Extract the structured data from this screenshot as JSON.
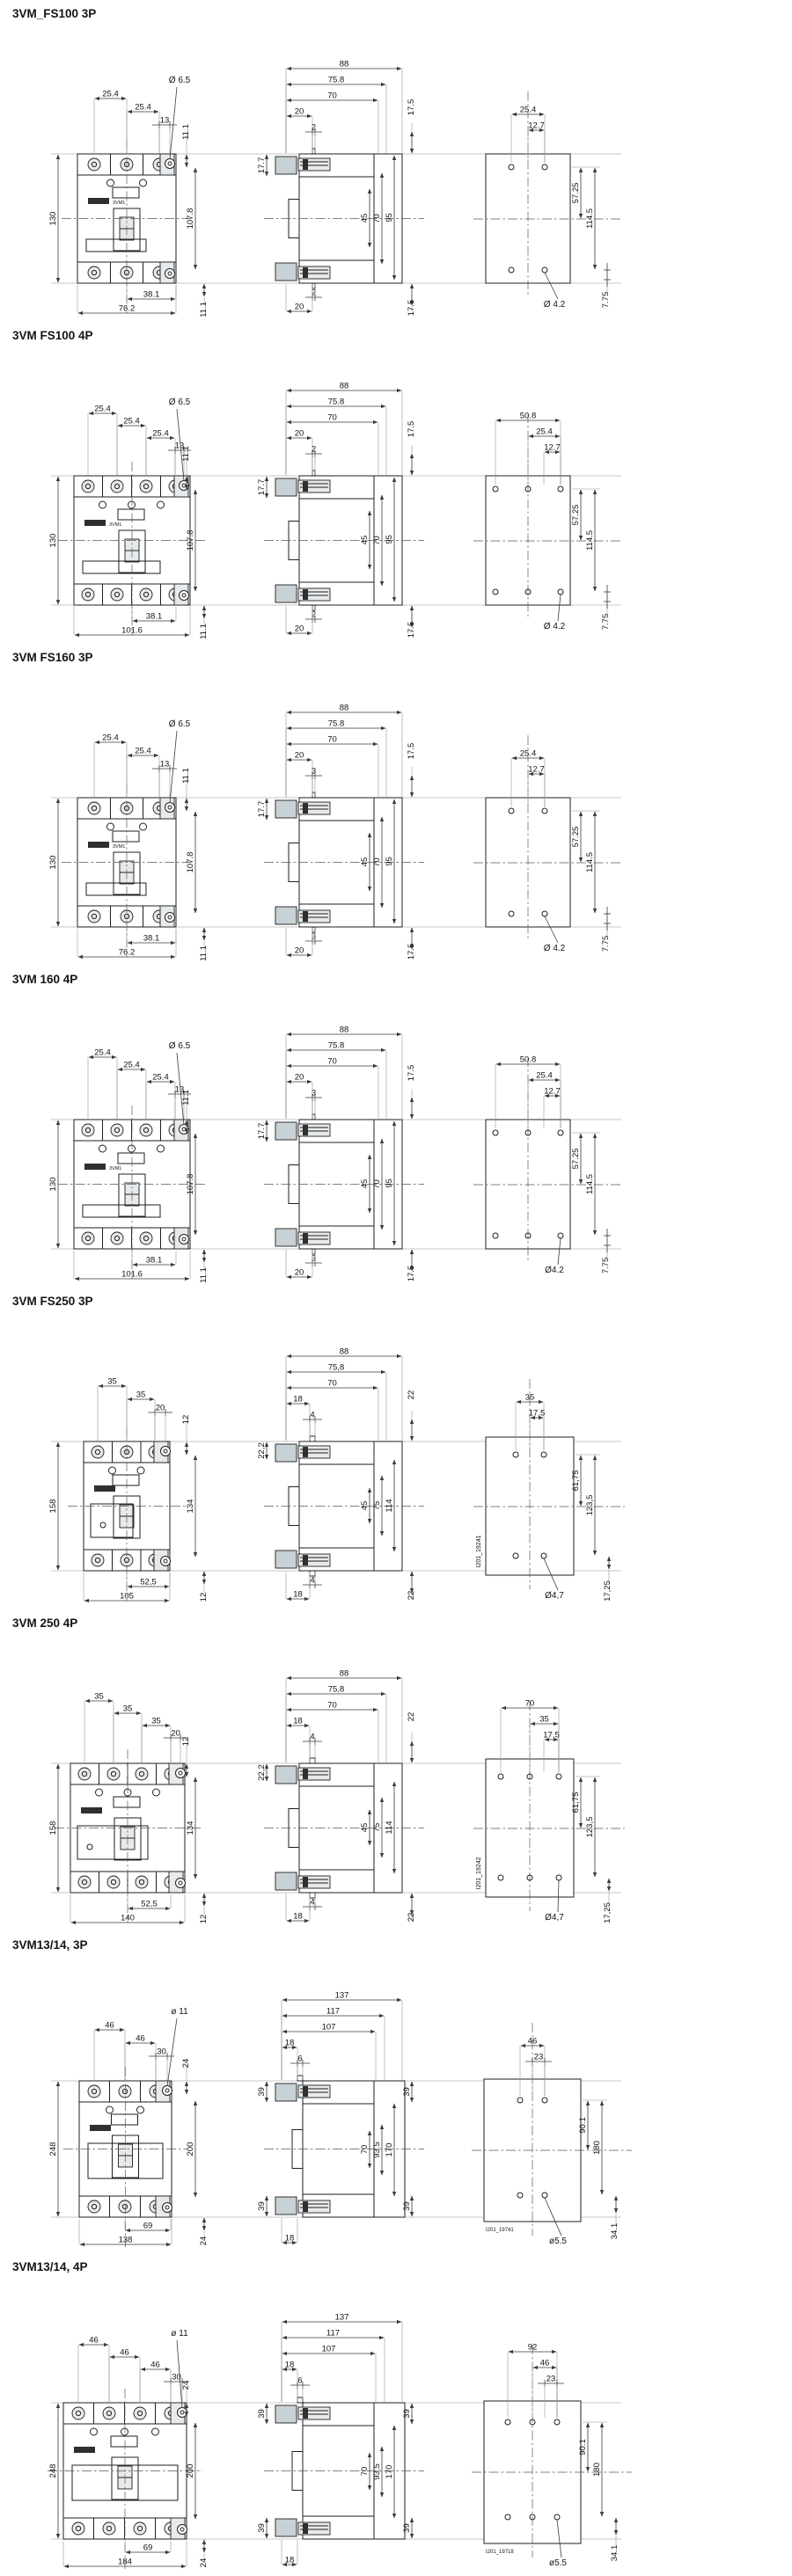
{
  "document_title": "3VM molded case circuit breaker dimension drawings",
  "palette": {
    "background": "#ffffff",
    "line": "#1f1f1f",
    "dimension_line": "#3a3a3a",
    "clamp_fill": "#c8d1d6",
    "light_fill": "#e7eaec"
  },
  "sections": [
    {
      "title": "3VM_FS100 3P",
      "family": "A",
      "poles": 3,
      "front": {
        "pitches": [
          "25.4",
          "25.4"
        ],
        "tab": "13",
        "hole": "Ø 6.5",
        "top_right": "11.1",
        "left": "130",
        "right": "107.8",
        "half": "38.1",
        "full": "76.2",
        "bottom_right": "11.1",
        "badge": "3VM1"
      },
      "side": {
        "widths": [
          "88",
          "75.8",
          "70",
          "20",
          "2"
        ],
        "top_left": "17.7",
        "top_right": "17.5",
        "inner": [
          "45",
          "70",
          "95"
        ],
        "bottom_small": "2",
        "bottom": "20",
        "bottom_right": "17.5"
      },
      "drill": {
        "top": [
          "25.4",
          "12.7"
        ],
        "right": [
          "57.25",
          "114.5"
        ],
        "hole": "Ø 4.2",
        "bottom_right": "7.75",
        "doc_id": null
      }
    },
    {
      "title": "3VM FS100 4P",
      "family": "A",
      "poles": 4,
      "front": {
        "pitches": [
          "25.4",
          "25.4",
          "25.4"
        ],
        "tab": "13",
        "hole": "Ø 6.5",
        "top_right": "11.1",
        "left": "130",
        "right": "107.8",
        "half": "38.1",
        "full": "101.6",
        "bottom_right": "11.1",
        "badge": "3VM1"
      },
      "side": {
        "widths": [
          "88",
          "75.8",
          "70",
          "20",
          "2"
        ],
        "top_left": "17.7",
        "top_right": "17.5",
        "inner": [
          "45",
          "70",
          "95"
        ],
        "bottom_small": "2",
        "bottom": "20",
        "bottom_right": "17.5"
      },
      "drill": {
        "top": [
          "50.8",
          "25.4",
          "12.7"
        ],
        "right": [
          "57.25",
          "114.5"
        ],
        "hole": "Ø 4.2",
        "bottom_right": "7.75",
        "doc_id": null
      }
    },
    {
      "title": "3VM FS160 3P",
      "family": "A",
      "poles": 3,
      "front": {
        "pitches": [
          "25.4",
          "25.4"
        ],
        "tab": "13",
        "hole": "Ø 6.5",
        "top_right": "11.1",
        "left": "130",
        "right": "107.8",
        "half": "38.1",
        "full": "76.2",
        "bottom_right": "11.1",
        "badge": "3VM1"
      },
      "side": {
        "widths": [
          "88",
          "75.8",
          "70",
          "20",
          "3"
        ],
        "top_left": "17.7",
        "top_right": "17.5",
        "inner": [
          "45",
          "70",
          "95"
        ],
        "bottom_small": "3",
        "bottom": "20",
        "bottom_right": "17.5"
      },
      "drill": {
        "top": [
          "25.4",
          "12.7"
        ],
        "right": [
          "57.25",
          "114.5"
        ],
        "hole": "Ø 4.2",
        "bottom_right": "7.75",
        "doc_id": null
      }
    },
    {
      "title": "3VM 160 4P",
      "family": "A",
      "poles": 4,
      "front": {
        "pitches": [
          "25.4",
          "25.4",
          "25.4"
        ],
        "tab": "13",
        "hole": "Ø 6.5",
        "top_right": "11.1",
        "left": "130",
        "right": "107.8",
        "half": "38.1",
        "full": "101.6",
        "bottom_right": "11.1",
        "badge": "3VM1"
      },
      "side": {
        "widths": [
          "88",
          "75.8",
          "70",
          "20",
          "3"
        ],
        "top_left": "17.7",
        "top_right": "17.5",
        "inner": [
          "45",
          "70",
          "95"
        ],
        "bottom_small": "3",
        "bottom": "20",
        "bottom_right": "17.5"
      },
      "drill": {
        "top": [
          "50.8",
          "25.4",
          "12.7"
        ],
        "right": [
          "57.25",
          "114.5"
        ],
        "hole": "Ø4.2",
        "bottom_right": "7.75",
        "doc_id": null
      }
    },
    {
      "title": "3VM FS250 3P",
      "family": "B",
      "poles": 3,
      "front": {
        "pitches": [
          "35",
          "35"
        ],
        "tab": "20",
        "hole": null,
        "top_right": "12",
        "left": "158",
        "right": "134",
        "half": "52,5",
        "full": "105",
        "bottom_right": "12",
        "badge": null
      },
      "side": {
        "widths": [
          "88",
          "75,8",
          "70",
          "18",
          "4"
        ],
        "top_left": "22,2",
        "top_right": "22",
        "inner": [
          "45",
          "75",
          "114"
        ],
        "bottom_small": "4",
        "bottom": "18",
        "bottom_right": "22"
      },
      "drill": {
        "top": [
          "35",
          "17,5"
        ],
        "right": [
          "61,75",
          "123,5"
        ],
        "hole": "Ø4,7",
        "bottom_right": "17,25",
        "doc_id": "I201_19241"
      }
    },
    {
      "title": "3VM 250 4P",
      "family": "B",
      "poles": 4,
      "front": {
        "pitches": [
          "35",
          "35",
          "35"
        ],
        "tab": "20",
        "hole": null,
        "top_right": "12",
        "left": "158",
        "right": "134",
        "half": "52,5",
        "full": "140",
        "bottom_right": "12",
        "badge": null
      },
      "side": {
        "widths": [
          "88",
          "75,8",
          "70",
          "18",
          "4"
        ],
        "top_left": "22,2",
        "top_right": "22",
        "inner": [
          "45",
          "75",
          "114"
        ],
        "bottom_small": "4",
        "bottom": "18",
        "bottom_right": "22"
      },
      "drill": {
        "top": [
          "70",
          "35",
          "17,5"
        ],
        "right": [
          "61,75",
          "123,5"
        ],
        "hole": "Ø4,7",
        "bottom_right": "17,25",
        "doc_id": "I201_19242"
      }
    },
    {
      "title": "3VM13/14, 3P",
      "family": "C",
      "poles": 3,
      "front": {
        "pitches": [
          "46",
          "46"
        ],
        "tab": "30",
        "hole": "ø 11",
        "top_right": "24",
        "left": "248",
        "right": "200",
        "half": "69",
        "full": "138",
        "bottom_right": "24",
        "badge": null
      },
      "side": {
        "widths": [
          "137",
          "117",
          "107",
          "18",
          "6"
        ],
        "top_left": "39",
        "top_right": "39",
        "bottom_left": "39",
        "inner": [
          "70",
          "93.5",
          "170"
        ],
        "bottom_small": null,
        "bottom": "18",
        "bottom_right": "39"
      },
      "drill": {
        "top": [
          "46",
          "23"
        ],
        "right": [
          "90.1",
          "180"
        ],
        "hole": "ø5.5",
        "bottom_right": "34.1",
        "doc_id": "I201_19741"
      }
    },
    {
      "title": "3VM13/14, 4P",
      "family": "C",
      "poles": 4,
      "front": {
        "pitches": [
          "46",
          "46",
          "46"
        ],
        "tab": "30",
        "hole": "ø 11",
        "top_right": "24",
        "left": "248",
        "right": "200",
        "half": "69",
        "full": "184",
        "bottom_right": "24",
        "badge": null
      },
      "side": {
        "widths": [
          "137",
          "117",
          "107",
          "18",
          "6"
        ],
        "top_left": "39",
        "top_right": "39",
        "bottom_left": "39",
        "inner": [
          "70",
          "93.5",
          "170"
        ],
        "bottom_small": null,
        "bottom": "18",
        "bottom_right": "39"
      },
      "drill": {
        "top": [
          "92",
          "46",
          "23"
        ],
        "right": [
          "90.1",
          "180"
        ],
        "hole": "ø5.5",
        "bottom_right": "34.1",
        "doc_id": "I201_19718"
      }
    }
  ]
}
